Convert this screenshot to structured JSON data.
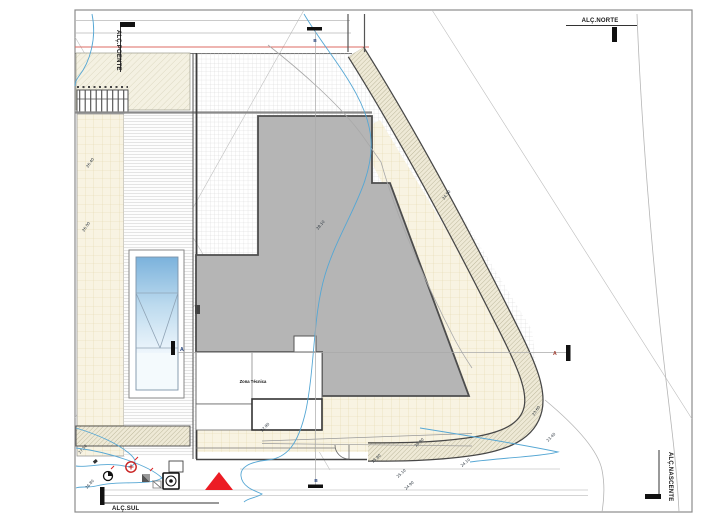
{
  "drawing": {
    "elevation_markers": {
      "poente": "ALÇ.POENTE",
      "norte": "ALÇ.NORTE",
      "sul": "ALÇ.SUL",
      "nascente": "ALÇ.NASCENTE"
    },
    "section_markers": {
      "a": "A",
      "b": "B"
    },
    "labels": {
      "zona_tecnica": "Zona Técnica"
    },
    "spot_elevations": [
      {
        "value": "28.10",
        "x": 318,
        "y": 230,
        "rot": -50
      },
      {
        "value": "26.40",
        "x": 88,
        "y": 168,
        "rot": -55
      },
      {
        "value": "26.00",
        "x": 84,
        "y": 232,
        "rot": -55
      },
      {
        "value": "27.90",
        "x": 262,
        "y": 432,
        "rot": -45
      },
      {
        "value": "26.90",
        "x": 416,
        "y": 447,
        "rot": -42
      },
      {
        "value": "25.80",
        "x": 373,
        "y": 463,
        "rot": -42
      },
      {
        "value": "25.10",
        "x": 398,
        "y": 478,
        "rot": -42
      },
      {
        "value": "24.90",
        "x": 406,
        "y": 490,
        "rot": -42
      },
      {
        "value": "24.50",
        "x": 444,
        "y": 200,
        "rot": -52
      },
      {
        "value": "24.10",
        "x": 462,
        "y": 467,
        "rot": -40
      },
      {
        "value": "23.60",
        "x": 534,
        "y": 416,
        "rot": -55
      },
      {
        "value": "23.40",
        "x": 548,
        "y": 442,
        "rot": -45
      },
      {
        "value": "27.50",
        "x": 80,
        "y": 454,
        "rot": -48
      },
      {
        "value": "26.80",
        "x": 87,
        "y": 489,
        "rot": -48
      }
    ],
    "symbols": [
      "survey-point",
      "hydrant-marker",
      "valve-marker",
      "utility-box",
      "entrance-triangle"
    ],
    "colors": {
      "contour_blue": "#56a7d4",
      "roof_gray": "#b5b5b5",
      "terrace_beige": "#f8f3e2",
      "marker_red": "#ec1c24",
      "red_line": "#dd6b63"
    }
  }
}
